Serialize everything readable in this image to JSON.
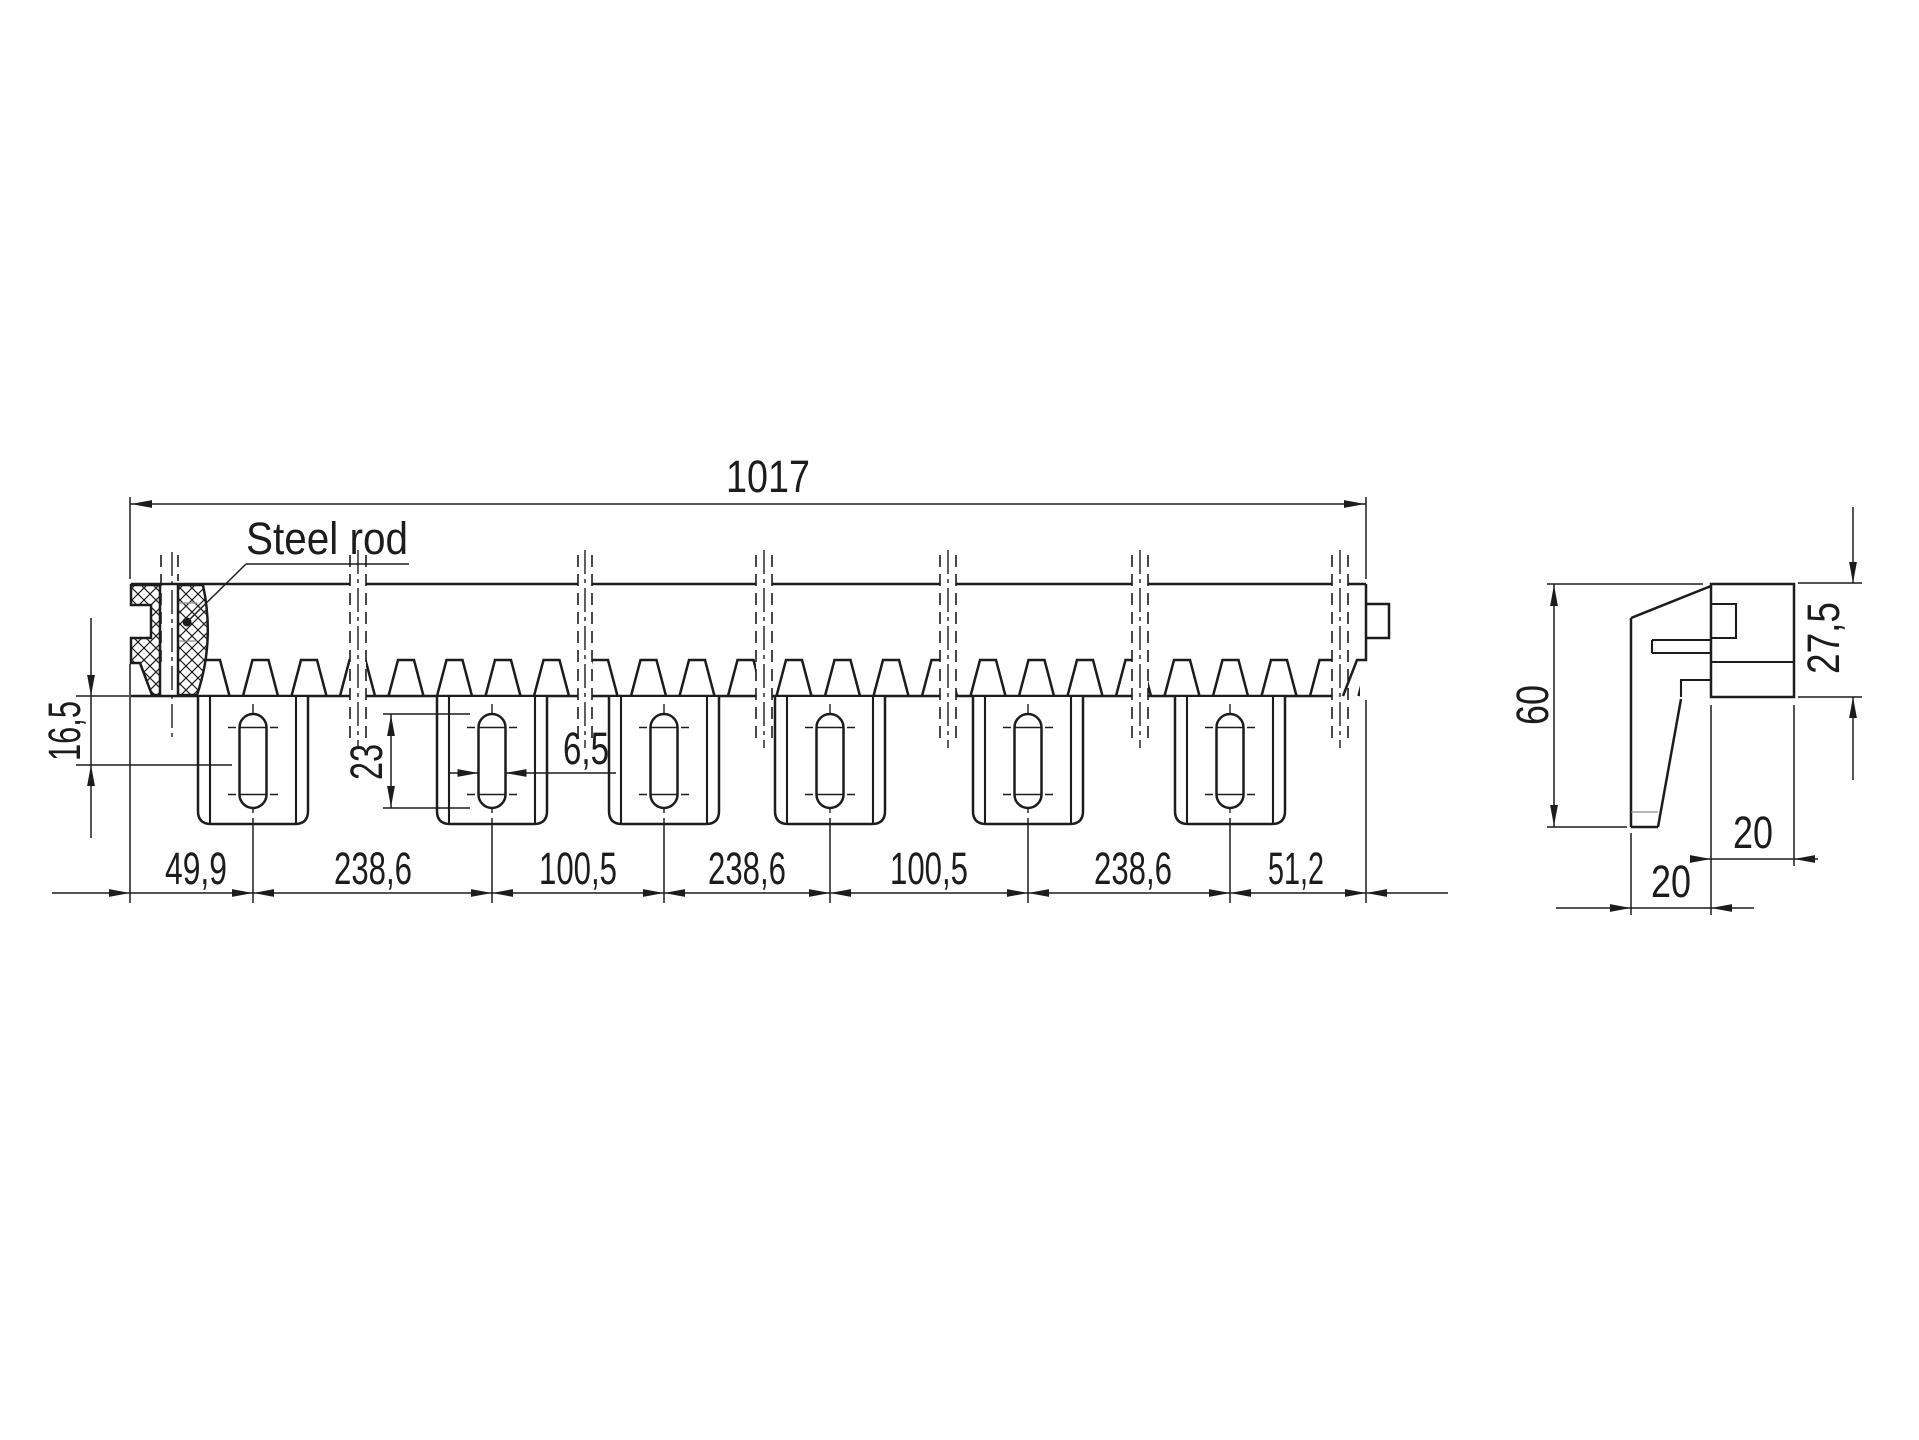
{
  "drawing": {
    "colors": {
      "line": "#1c1c1c",
      "background": "#ffffff"
    },
    "front_view": {
      "label_steel_rod": "Steel rod",
      "dim_total_length": "1017",
      "dim_height_left": "16,5",
      "dim_slot_length": "23",
      "dim_slot_width": "6,5",
      "dim_chain": [
        "49,9",
        "238,6",
        "100,5",
        "238,6",
        "100,5",
        "238,6",
        "51,2"
      ]
    },
    "side_view": {
      "dim_height": "60",
      "dim_upper_height": "27,5",
      "dim_width_top": "20",
      "dim_width_bottom": "20"
    }
  }
}
